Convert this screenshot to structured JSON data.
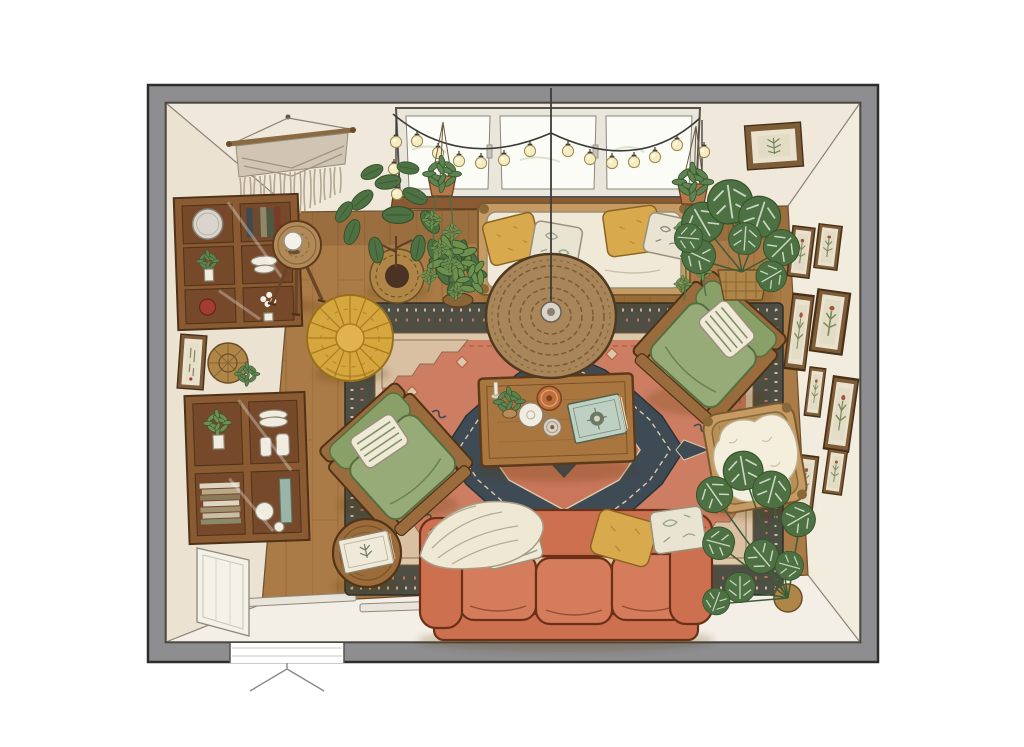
{
  "title": "Top-down illustrated living room floor plan",
  "dimensions": {
    "width": 1024,
    "height": 747
  },
  "palette": {
    "bg": "#ffffff",
    "wall_outer": "#8e8e90",
    "wall_line": "#2e2d2b",
    "wall_face_top": "#efe8db",
    "wall_face_left": "#ebe2d2",
    "wall_face_right": "#f2ecdf",
    "wall_face_bottom": "#f3efe6",
    "corner_line": "#8b8476",
    "floor": "#aa7b46",
    "floor_line": "#8a5c30",
    "entry_bar": "#e9e5da",
    "rug_border": "#4e4e44",
    "rug_cream": "#dcc7a9",
    "rug_field": "#cd7e62",
    "rug_navy": "#3f4b54",
    "rug_red": "#c9765a",
    "rug_motif_line": "#b25c42",
    "sofa": "#cd7050",
    "sofa_cushion": "#d57c5c",
    "sofa_line": "#6b3018",
    "green_seat": "#97ab78",
    "green_back": "#89a068",
    "green_line": "#55703f",
    "wood": "#9a6b3c",
    "wood_dark": "#4f3318",
    "wood_face": "#8a5a33",
    "wood_cell": "#75492a",
    "rattan": "#c59a63",
    "rattan_line": "#7a5a2e",
    "basket": "#b08648",
    "basket_line": "#6b4e26",
    "pouf": "#d7a73f",
    "pouf_line": "#a87c1e",
    "cream_fabric": "#f0e9d8",
    "fabric_line": "#9a8f78",
    "mustard": "#d9a94e",
    "mustard_line": "#8a6420",
    "floral": "#e9e3d2",
    "pattern_green": "#98a486",
    "plant_dark": "#4e7143",
    "plant_mid": "#5f8350",
    "plant_light": "#6f9150",
    "plant_line": "#35522c",
    "sheepskin": "#f4eedd",
    "sheepskin_line": "#bdae8e",
    "frame_wood": "#7d5c38",
    "frame_mat": "#eae2cf",
    "macrame": "#cfc5b2",
    "macrame_line": "#968c7a",
    "bulb": "#f6ecc0",
    "glass": "#fcfcf6",
    "window_frame": "#e9e6db",
    "cord": "#3c3c3c",
    "tray": "#c06f3c",
    "book_teal": "#bed0c2",
    "red_accent": "#a23c2e",
    "white_item": "#f1ece0",
    "shadow": "rgba(80,50,25,0.22)"
  },
  "scene": {
    "view": "top-down interior illustration",
    "room": "living room",
    "window_panes": 3,
    "string_light_bulbs": 17,
    "gallery_frames_right_wall": 8,
    "daybed_pillows": 4,
    "sofa_pillows": 3,
    "sofa_seat_cushions": 3,
    "armchairs": 2,
    "objects": [
      "macrame-wall-hanging",
      "string-lights",
      "window",
      "hanging-plant-left",
      "hanging-plant-right",
      "framed-print-top-wall",
      "daybed-with-pillows",
      "fiddle-leaf-fig",
      "potted-plant",
      "monstera-top-right",
      "monstera-bottom-right",
      "wall-shelf-upper",
      "wall-shelf-lower",
      "small-frame-left-wall",
      "woven-wall-basket",
      "side-table-with-lamp",
      "moroccan-pouf",
      "rattan-pendant-lamp",
      "persian-rug",
      "coffee-table",
      "candlestick",
      "table-plant",
      "white-pitcher",
      "orange-tray",
      "small-bowl",
      "botanical-book",
      "armchair-right",
      "armchair-left",
      "rattan-chair-with-sheepskin",
      "side-table-with-books",
      "throw-blanket",
      "terracotta-sofa",
      "gallery-wall",
      "door-opening",
      "wall-panel"
    ]
  }
}
